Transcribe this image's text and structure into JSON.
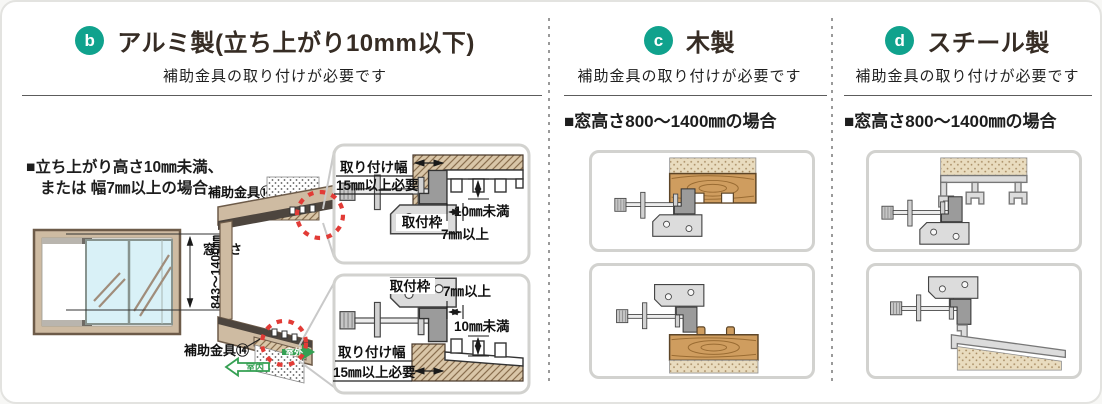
{
  "page": {
    "type": "window-mounting-instructions"
  },
  "colors": {
    "badge": "#10a28d",
    "highlight_red": "#e23b36",
    "arrow_green": "#35a053",
    "wood": "#cf9d5f",
    "frame_tan": "#cebba2",
    "glass_blue": "#d9f1f7"
  },
  "sections": {
    "b": {
      "badge": "b",
      "title": "アルミ製(立ち上がり10mm以下)",
      "subtitle": "補助金具の取り付けが必要です",
      "note_line1": "■立ち上がり高さ10㎜未満、",
      "note_line2": "または 幅7㎜以上の場合",
      "window_dim_label": "窓高さ",
      "window_dim_value": "843～1400㎜",
      "part_label": "補助金具⑭",
      "arrow_inside": "室内",
      "arrow_outside": "室外",
      "labels": {
        "width": "取り付け幅",
        "width_req": "15㎜以上必要",
        "clearance": "10㎜未満",
        "depth": "7㎜以上",
        "frame": "取付枠"
      }
    },
    "c": {
      "badge": "c",
      "title": "木製",
      "subtitle": "補助金具の取り付けが必要です",
      "case_heading": "■窓高さ800～1400㎜の場合"
    },
    "d": {
      "badge": "d",
      "title": "スチール製",
      "subtitle": "補助金具の取り付けが必要です",
      "case_heading": "■窓高さ800～1400㎜の場合"
    }
  }
}
